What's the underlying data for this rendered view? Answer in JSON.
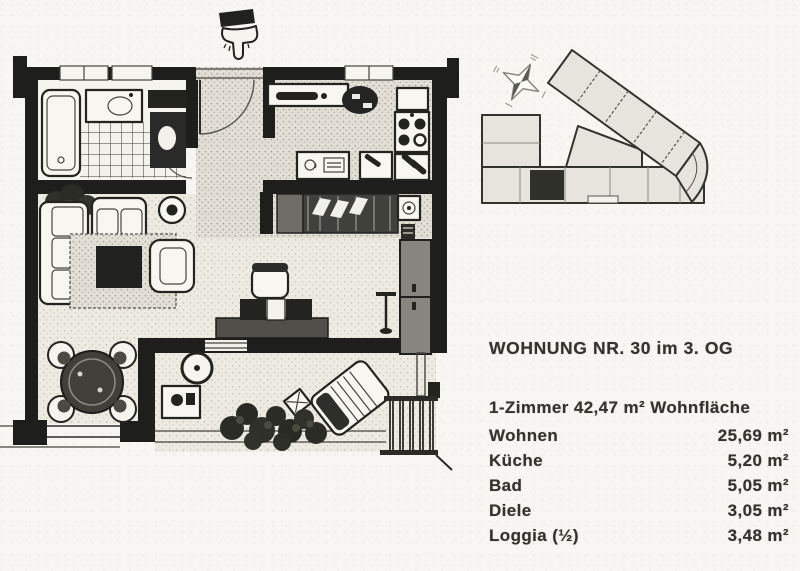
{
  "colors": {
    "paper": "#f7f6f2",
    "ink": "#1e1e1d",
    "highlighted_unit": "#30302b"
  },
  "icons": {
    "hand_pointer": "hand-pointer-down-icon",
    "compass": "compass-rose-icon"
  },
  "apartment": {
    "title": "WOHNUNG NR. 30 im 3. OG",
    "summary": "1-Zimmer 42,47 m² Wohnfläche",
    "rooms": [
      {
        "label": "Wohnen",
        "value": "25,69 m²"
      },
      {
        "label": "Küche",
        "value": "5,20 m²"
      },
      {
        "label": "Bad",
        "value": "5,05 m²"
      },
      {
        "label": "Diele",
        "value": "3,05 m²"
      },
      {
        "label": "Loggia (½)",
        "value": "3,48 m²"
      }
    ]
  }
}
